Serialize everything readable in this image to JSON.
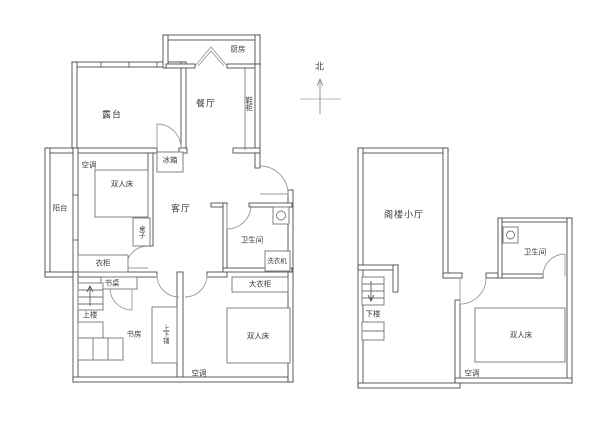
{
  "title": "apartment-floor-plan",
  "compass": {
    "north": "北"
  },
  "colors": {
    "wall": "#4d4d4d",
    "furniture": "#757575",
    "door_arc": "#9a9a9a",
    "text": "#3c3c3c",
    "background": "#ffffff"
  },
  "floor1": {
    "terrace": "露台",
    "kitchen": "厨房",
    "dining": "餐厅",
    "shoe_cabinet": "鞋柜",
    "fridge": "冰箱",
    "ac_bedroom1": "空调",
    "double_bed1": "双人床",
    "balcony": "阳台",
    "living": "客厅",
    "table": "桌子",
    "wardrobe": "衣柜",
    "bathroom": "卫生间",
    "washing_machine": "洗衣机",
    "big_wardrobe": "大衣柜",
    "desk": "书桌",
    "upstairs": "上楼",
    "study": "书房",
    "bunk_bed": "上下铺",
    "double_bed2": "双人床",
    "ac_bedroom2": "空调"
  },
  "floor2": {
    "attic_hall": "阁楼小厅",
    "bathroom": "卫生间",
    "downstairs": "下楼",
    "double_bed": "双人床",
    "ac": "空调"
  }
}
